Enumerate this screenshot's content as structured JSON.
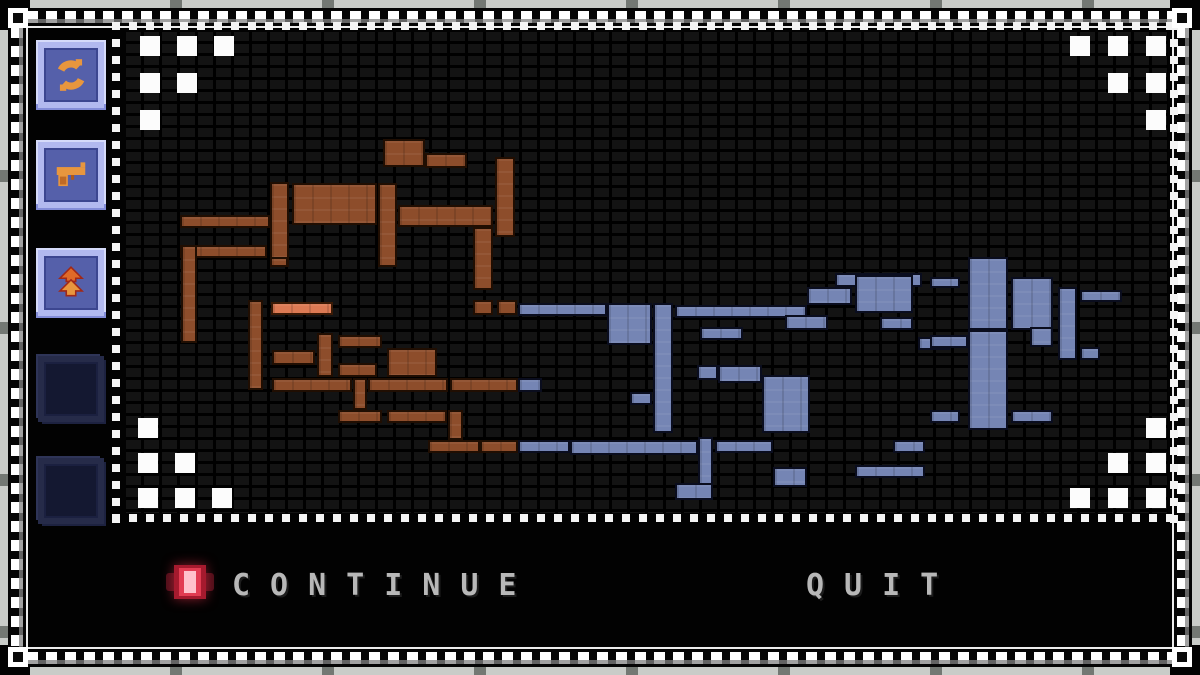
{
  "menu": {
    "options": [
      {
        "label": "CONTINUE",
        "selected": true
      },
      {
        "label": "QUIT",
        "selected": false
      }
    ]
  },
  "sidebar": {
    "slots": [
      {
        "id": "slot-1",
        "icon": "circular-arrows-icon",
        "state": "filled"
      },
      {
        "id": "slot-2",
        "icon": "pistol-icon",
        "state": "filled"
      },
      {
        "id": "slot-3",
        "icon": "double-chevron-up-icon",
        "state": "filled"
      },
      {
        "id": "slot-4",
        "icon": "",
        "state": "empty"
      },
      {
        "id": "slot-5",
        "icon": "",
        "state": "empty"
      }
    ]
  },
  "map": {
    "colors": {
      "brown": "#8d4d2b",
      "blue": "#7585b4",
      "highlight": "#dc7a54"
    },
    "highlight_room": [
      [
        145,
        270,
        62,
        13
      ]
    ],
    "rooms_brown": [
      [
        257,
        107,
        42,
        28
      ],
      [
        299,
        121,
        42,
        15
      ],
      [
        144,
        150,
        19,
        85
      ],
      [
        166,
        151,
        85,
        42
      ],
      [
        252,
        151,
        19,
        84
      ],
      [
        54,
        183,
        90,
        13
      ],
      [
        272,
        173,
        95,
        22
      ],
      [
        369,
        125,
        20,
        80
      ],
      [
        347,
        195,
        20,
        63
      ],
      [
        54,
        213,
        87,
        13
      ],
      [
        144,
        225,
        18,
        10
      ],
      [
        55,
        213,
        16,
        98
      ],
      [
        122,
        268,
        15,
        90
      ],
      [
        191,
        301,
        16,
        44
      ],
      [
        146,
        318,
        43,
        15
      ],
      [
        212,
        303,
        44,
        13
      ],
      [
        212,
        331,
        39,
        14
      ],
      [
        146,
        346,
        80,
        14
      ],
      [
        227,
        346,
        14,
        32
      ],
      [
        242,
        346,
        80,
        14
      ],
      [
        261,
        316,
        50,
        29
      ],
      [
        324,
        346,
        68,
        14
      ],
      [
        212,
        378,
        44,
        13
      ],
      [
        261,
        378,
        60,
        13
      ],
      [
        322,
        378,
        15,
        30
      ],
      [
        302,
        408,
        52,
        13
      ],
      [
        354,
        408,
        38,
        13
      ],
      [
        347,
        268,
        20,
        15
      ],
      [
        371,
        268,
        20,
        15
      ]
    ],
    "rooms_blue": [
      [
        392,
        271,
        89,
        13
      ],
      [
        481,
        271,
        45,
        42
      ],
      [
        527,
        271,
        20,
        130
      ],
      [
        549,
        273,
        132,
        13
      ],
      [
        659,
        283,
        43,
        15
      ],
      [
        681,
        255,
        45,
        18
      ],
      [
        709,
        241,
        87,
        14
      ],
      [
        729,
        243,
        58,
        38
      ],
      [
        754,
        285,
        33,
        13
      ],
      [
        574,
        295,
        43,
        13
      ],
      [
        792,
        305,
        32,
        13
      ],
      [
        804,
        245,
        30,
        11
      ],
      [
        842,
        225,
        40,
        73
      ],
      [
        885,
        245,
        42,
        53
      ],
      [
        842,
        298,
        40,
        100
      ],
      [
        804,
        303,
        38,
        13
      ],
      [
        932,
        255,
        19,
        73
      ],
      [
        954,
        258,
        42,
        12
      ],
      [
        954,
        315,
        20,
        13
      ],
      [
        904,
        295,
        23,
        20
      ],
      [
        804,
        378,
        30,
        13
      ],
      [
        885,
        378,
        42,
        13
      ],
      [
        504,
        360,
        22,
        13
      ],
      [
        636,
        343,
        48,
        58
      ],
      [
        571,
        333,
        21,
        15
      ],
      [
        592,
        333,
        44,
        18
      ],
      [
        392,
        346,
        24,
        14
      ],
      [
        392,
        408,
        52,
        13
      ],
      [
        444,
        408,
        128,
        15
      ],
      [
        572,
        405,
        15,
        50
      ],
      [
        589,
        408,
        58,
        13
      ],
      [
        647,
        435,
        34,
        20
      ],
      [
        549,
        451,
        38,
        17
      ],
      [
        729,
        433,
        70,
        13
      ],
      [
        767,
        408,
        32,
        13
      ]
    ],
    "corner_markers": {
      "top_left": [
        [
          14,
          4
        ],
        [
          51,
          4
        ],
        [
          88,
          4
        ],
        [
          14,
          41
        ],
        [
          51,
          41
        ],
        [
          14,
          78
        ]
      ],
      "top_right": [
        [
          944,
          4
        ],
        [
          982,
          4
        ],
        [
          1020,
          4
        ],
        [
          982,
          41
        ],
        [
          1020,
          41
        ],
        [
          1020,
          78
        ]
      ],
      "bottom_left": [
        [
          12,
          386
        ],
        [
          12,
          421
        ],
        [
          49,
          421
        ],
        [
          12,
          456
        ],
        [
          49,
          456
        ],
        [
          86,
          456
        ]
      ],
      "bottom_right": [
        [
          1020,
          386
        ],
        [
          982,
          421
        ],
        [
          1020,
          421
        ],
        [
          944,
          456
        ],
        [
          982,
          456
        ],
        [
          1020,
          456
        ]
      ]
    }
  }
}
